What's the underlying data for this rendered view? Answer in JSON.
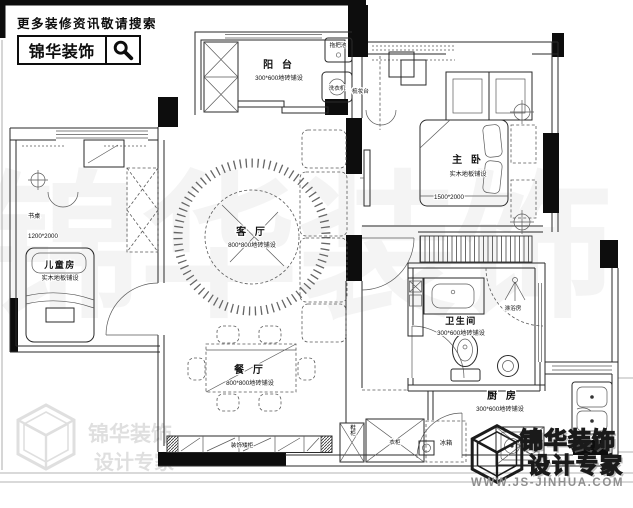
{
  "header": {
    "notice": "更多装修资讯敬请搜索",
    "brand": "锦华装饰"
  },
  "plan": {
    "rooms": {
      "balcony": {
        "name": "阳 台",
        "floor": "300*600地砖铺设"
      },
      "living": {
        "name": "客 厅",
        "floor": "800*800地砖铺设"
      },
      "dining": {
        "name": "餐 厅",
        "floor": "800*800地砖铺设"
      },
      "master": {
        "name": "主 卧",
        "floor": "实木地板铺设",
        "bed_dim": "1500*2000"
      },
      "kids": {
        "name": "儿童房",
        "floor": "实木地板铺设",
        "bed_dim": "1200*2000",
        "desk": "书桌"
      },
      "bath": {
        "name": "卫生间",
        "floor": "300*600地砖铺设",
        "shower": "淋浴房"
      },
      "kitchen": {
        "name": "厨 房",
        "floor": "300*600地砖铺设",
        "fridge": "冰箱"
      }
    },
    "fixtures": {
      "mop_pool": "拖把池",
      "washer": "洗衣机",
      "dresser": "梳妆台",
      "shoe_cabinet": "鞋柜",
      "wardrobe": "衣柜",
      "low_cabinet": "装饰矮柜"
    }
  },
  "watermark": {
    "center_text": "锦华装饰",
    "corner_brand": "锦华装饰",
    "corner_tagline": "设计专家"
  },
  "footer": {
    "brand": "锦华装饰",
    "tagline": "设计专家",
    "website": "WWW.JS-JINHUA.COM"
  },
  "colors": {
    "ink": "#222222",
    "wall": "#0d0d0d",
    "watermark_gray": "rgba(55,55,55,0.06)",
    "website_gray": "#8f8f8f"
  }
}
